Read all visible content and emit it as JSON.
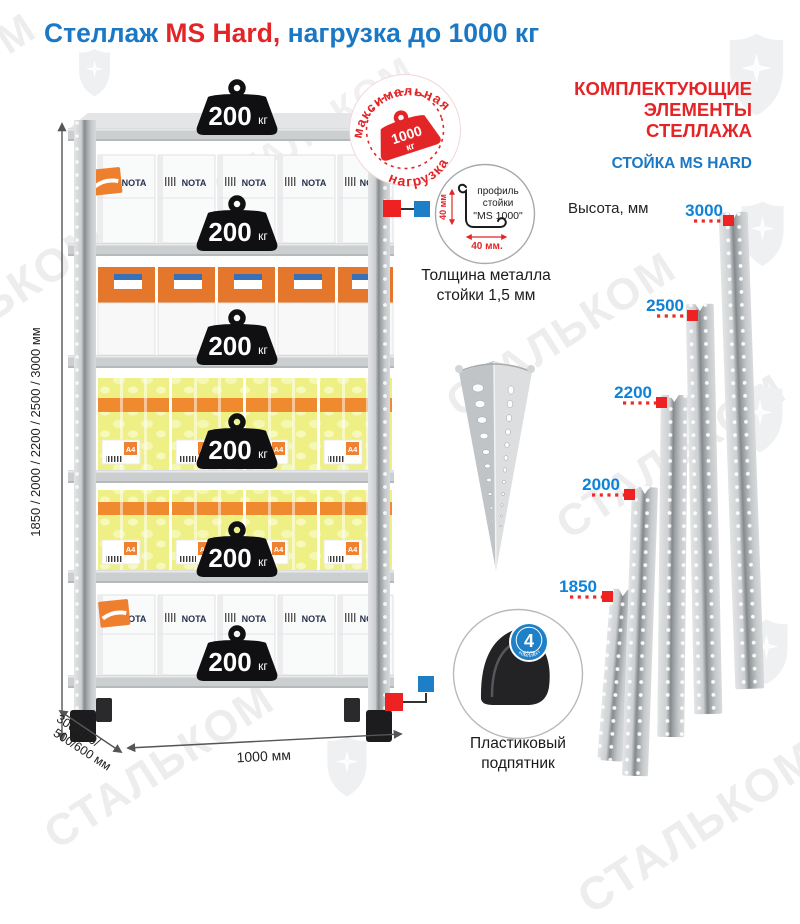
{
  "brand_watermark": "СТАЛЬКОМ",
  "title": {
    "prefix": "Стеллаж ",
    "model": "MS Hard,",
    "suffix": " нагрузка до 1000 кг"
  },
  "rack": {
    "shelf_load": "200",
    "shelf_load_unit": "кг",
    "max_badge": {
      "arc_top": "максимальная",
      "arc_bottom": "нагрузка",
      "value": "1000",
      "unit": "кг"
    },
    "box_brand": "NOTA",
    "box_a4": "A4",
    "dim_height": "1850 / 2000 / 2200 / 2500 / 3000 мм",
    "dim_depth_line1": "300/400/",
    "dim_depth_line2": "500/600 мм",
    "dim_width": "1000 мм"
  },
  "profile_detail": {
    "label_line1": "профиль",
    "label_line2": "стойки",
    "label_line3": "\"MS 1000\"",
    "dim_vertical": "40 мм",
    "dim_horizontal": "40 мм.",
    "caption_line1": "Толщина металла",
    "caption_line2": "стойки 1,5 мм"
  },
  "foot_detail": {
    "count": "4",
    "count_unit": "штуки",
    "count_note": "в комплекте",
    "caption_line1": "Пластиковый",
    "caption_line2": "подпятник"
  },
  "components": {
    "header_line1": "КОМПЛЕКТУЮЩИЕ",
    "header_line2": "ЭЛЕМЕНТЫ СТЕЛЛАЖА",
    "subheader": "СТОЙКА MS HARD",
    "height_label": "Высота, мм",
    "post_heights": [
      "3000",
      "2500",
      "2200",
      "2000",
      "1850"
    ]
  },
  "colors": {
    "title_blue": "#1b78c4",
    "brand_red": "#e42528",
    "label_blue": "#0e82d6",
    "marker_red": "#ee2222",
    "connector_blue": "#1d7fc6"
  }
}
